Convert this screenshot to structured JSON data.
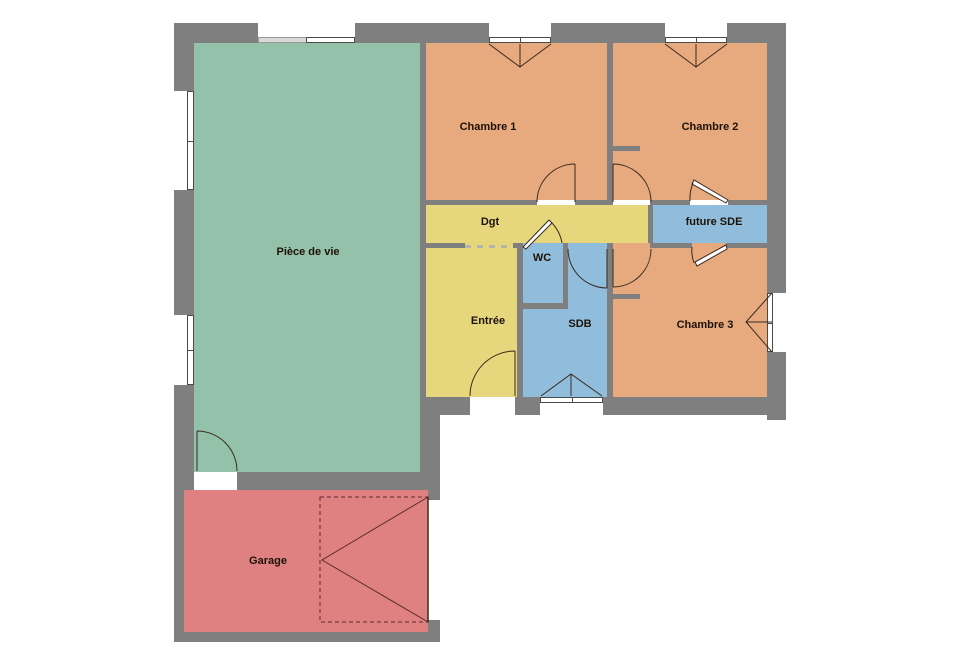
{
  "plan": {
    "type": "floor-plan",
    "rooms": {
      "piece_de_vie": {
        "label": "Pièce de vie",
        "color": "#94c1a9"
      },
      "chambre1": {
        "label": "Chambre 1",
        "color": "#e7a97e"
      },
      "chambre2": {
        "label": "Chambre 2",
        "color": "#e7a97e"
      },
      "chambre3": {
        "label": "Chambre 3",
        "color": "#e7a97e"
      },
      "dgt": {
        "label": "Dgt",
        "color": "#e6d77d"
      },
      "entree": {
        "label": "Entrée",
        "color": "#e6d77d"
      },
      "wc": {
        "label": "WC",
        "color": "#91bddc"
      },
      "sdb": {
        "label": "SDB",
        "color": "#91bddc"
      },
      "future_sde": {
        "label": "future SDE",
        "color": "#91bddc"
      },
      "garage": {
        "label": "Garage",
        "color": "#e08181"
      }
    },
    "colors": {
      "wall": "#7f7f7f",
      "line": "#3a2a1e",
      "garage_door_line": "#5c2a2a",
      "window_frame": "#4a4a4a",
      "bay_panel": "#d9d9d9",
      "background": "#ffffff"
    }
  }
}
